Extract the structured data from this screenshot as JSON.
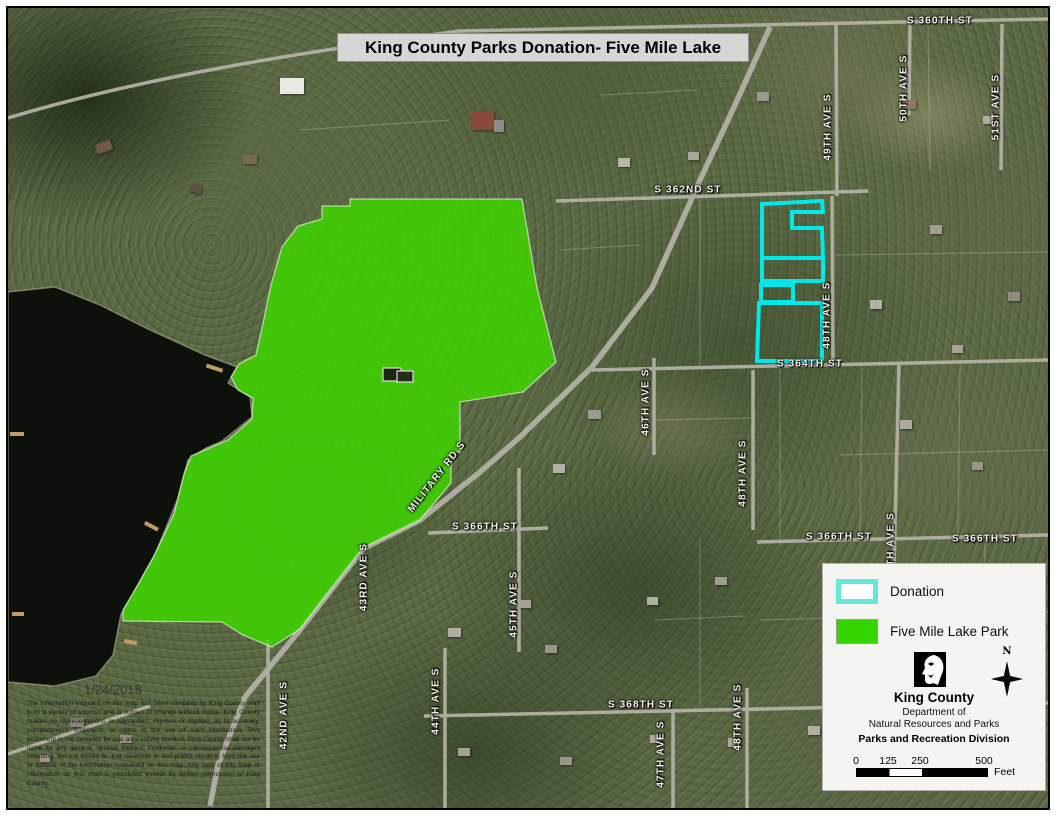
{
  "map": {
    "title": "King County Parks Donation- Five Mile Lake",
    "date": "1/24/2018",
    "disclaimer": "The information included on this map has been compiled by King County staff from a variety of sources and is subject to change without notice. King County makes no representations or warranties, express or implied, as to accuracy, completeness, timeliness, or rights to the use of such information. This document is not intended for use as a survey product. King County shall not be liable for any general, special, indirect, incidental, or consequential damages including, but not limited to, lost revenues or lost profits resulting from the use or misuse of the information contained on this map. Any sale of this map or information on this map is prohibited except by written permission of King County.",
    "street_labels": [
      {
        "text": "S 360TH ST",
        "x": 940,
        "y": 21,
        "rot": 0
      },
      {
        "text": "49TH AVE S",
        "x": 828,
        "y": 127,
        "rot": -90
      },
      {
        "text": "50TH AVE S",
        "x": 904,
        "y": 88,
        "rot": -90
      },
      {
        "text": "51ST AVE S",
        "x": 996,
        "y": 107,
        "rot": -90
      },
      {
        "text": "S 362ND ST",
        "x": 688,
        "y": 190,
        "rot": 0
      },
      {
        "text": "S 364TH ST",
        "x": 810,
        "y": 364,
        "rot": 0
      },
      {
        "text": "48TH AVE S",
        "x": 827,
        "y": 315,
        "rot": -90
      },
      {
        "text": "46TH AVE S",
        "x": 646,
        "y": 402,
        "rot": -90
      },
      {
        "text": "48TH AVE S",
        "x": 743,
        "y": 473,
        "rot": -90
      },
      {
        "text": "MILITARY RD S",
        "x": 437,
        "y": 477,
        "rot": -52
      },
      {
        "text": "S 366TH ST",
        "x": 485,
        "y": 527,
        "rot": 0
      },
      {
        "text": "S 366TH ST",
        "x": 839,
        "y": 537,
        "rot": 0
      },
      {
        "text": "S 366TH ST",
        "x": 985,
        "y": 539,
        "rot": 0
      },
      {
        "text": "TH AVE S",
        "x": 891,
        "y": 539,
        "rot": -90
      },
      {
        "text": "43RD AVE S",
        "x": 364,
        "y": 577,
        "rot": -90
      },
      {
        "text": "45TH AVE S",
        "x": 514,
        "y": 604,
        "rot": -90
      },
      {
        "text": "42ND AVE S",
        "x": 284,
        "y": 715,
        "rot": -90
      },
      {
        "text": "44TH AVE S",
        "x": 436,
        "y": 701,
        "rot": -90
      },
      {
        "text": "S 368TH ST",
        "x": 641,
        "y": 705,
        "rot": 0
      },
      {
        "text": "47TH AVE S",
        "x": 661,
        "y": 754,
        "rot": -90
      },
      {
        "text": "48TH AVE S",
        "x": 738,
        "y": 717,
        "rot": -90
      }
    ]
  },
  "legend": {
    "items": [
      {
        "label": "Donation",
        "swatch": "outline",
        "color": "#00E8E8"
      },
      {
        "label": "Five Mile Lake Park",
        "swatch": "fill",
        "color": "#35D500"
      }
    ],
    "agency": {
      "name": "King County",
      "dept1": "Department of",
      "dept2": "Natural Resources and Parks",
      "division": "Parks and Recreation Division"
    },
    "north_label": "N",
    "scale": {
      "ticks": [
        "0",
        "125",
        "250",
        "500"
      ],
      "unit": "Feet"
    }
  },
  "colors": {
    "donation_outline": "#00E8E8",
    "park_fill": "#3CD400"
  }
}
